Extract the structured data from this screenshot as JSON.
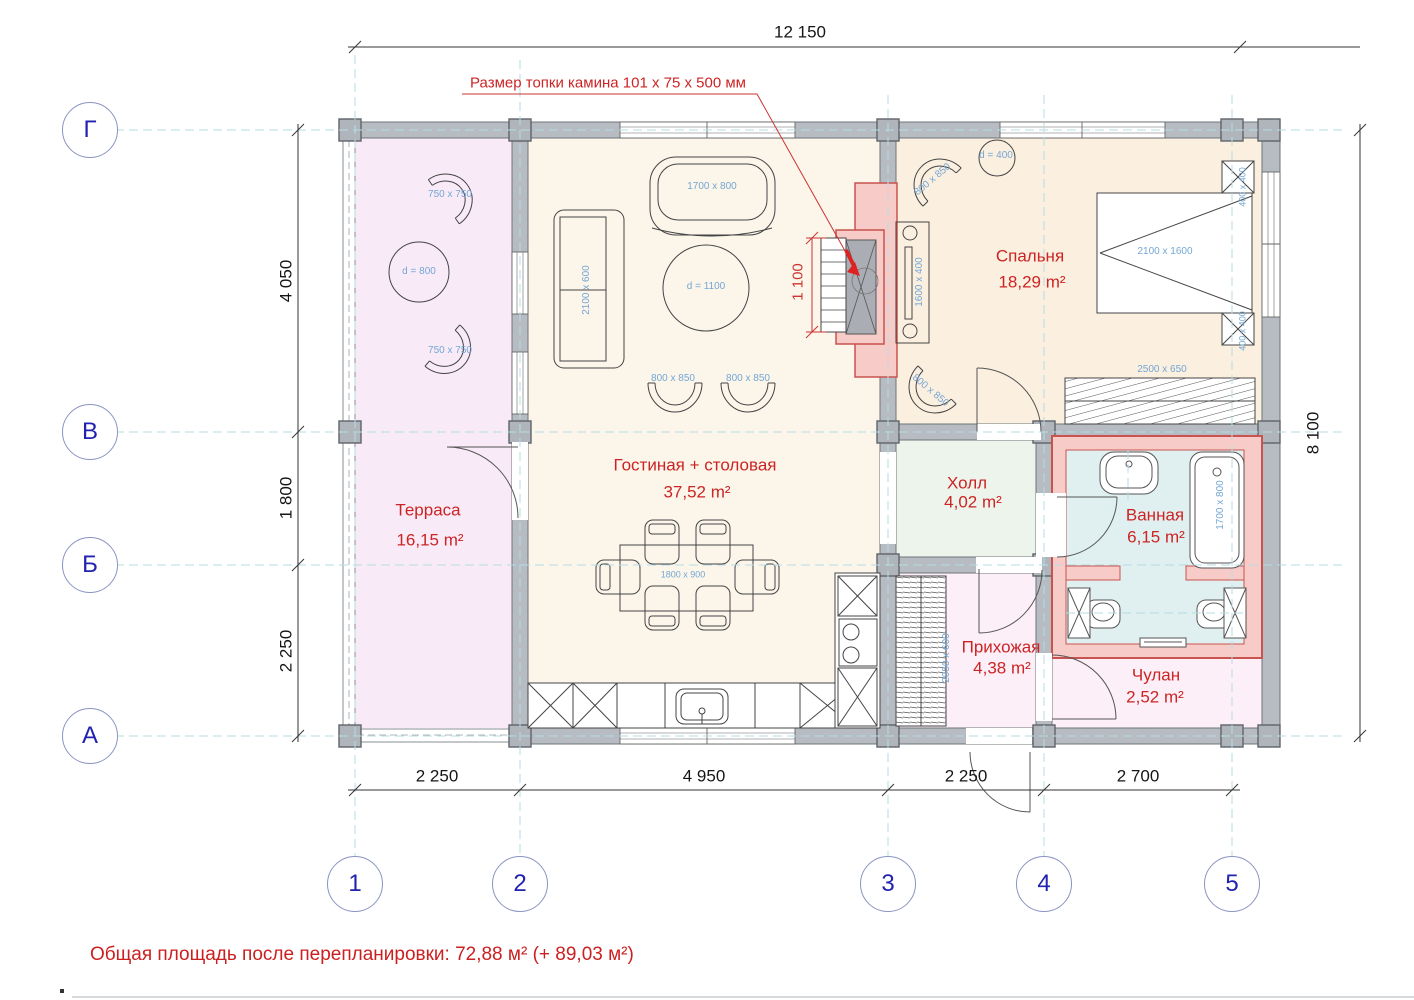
{
  "annotation": {
    "fireplace_note": "Размер топки камина 101 x 75 x 500 мм",
    "fireplace_firebox_dim": "1 100"
  },
  "summary": {
    "text": "Общая площадь после перепланировки: 72,88 м² (+ 89,03 м²)"
  },
  "grid": {
    "rows": [
      "Г",
      "В",
      "Б",
      "А"
    ],
    "cols": [
      "1",
      "2",
      "3",
      "4",
      "5"
    ]
  },
  "dimensions": {
    "top_total": "12 150",
    "right_total": "8 100",
    "left": [
      "4 050",
      "1 800",
      "2 250"
    ],
    "bottom": [
      "2 250",
      "4 950",
      "2 250",
      "2 700"
    ]
  },
  "rooms": [
    {
      "id": "terrace",
      "name": "Терраса",
      "area": "16,15 m²"
    },
    {
      "id": "living_dining",
      "name": "Гостиная + столовая",
      "area": "37,52 m²"
    },
    {
      "id": "bedroom",
      "name": "Спальня",
      "area": "18,29 m²"
    },
    {
      "id": "hall",
      "name": "Холл",
      "area": "4,02 m²"
    },
    {
      "id": "bathroom",
      "name": "Ванная",
      "area": "6,15 m²"
    },
    {
      "id": "entry",
      "name": "Прихожая",
      "area": "4,38 m²"
    },
    {
      "id": "closet",
      "name": "Чулан",
      "area": "2,52 m²"
    }
  ],
  "furniture": {
    "terrace_chair_top": "750 x 750",
    "terrace_table": "d = 800",
    "terrace_chair_bottom": "750 x 750",
    "sofa_top": "1700 x 800",
    "sofa_left": "2100 x 600",
    "coffee_table": "d = 1100",
    "armchair_left": "800 x 850",
    "armchair_right": "800 x 850",
    "dining_table": "1800 x 900",
    "bed": "2100 x 1600",
    "bedroom_chair_top": "800 x 850",
    "bedroom_side_table": "d = 400",
    "bedroom_desk": "1600 x 400",
    "bed_pillow_top": "400 x 400",
    "bed_pillow_bottom": "400 x 400",
    "bedroom_chair_bottom": "800 x 850",
    "bedroom_wardrobe": "2500 x 650",
    "bathtub": "1700 x 800",
    "entry_wardrobe": "2050 x 600"
  },
  "colors": {
    "annotation_red": "#cc2424",
    "furniture_label_blue": "#74a7d4",
    "grid_bubble_blue": "#2222b0",
    "wall_gray": "#b7bcc2",
    "bath_wall_red": "#c9534e",
    "axis_dash_cyan": "#b5dde6"
  }
}
